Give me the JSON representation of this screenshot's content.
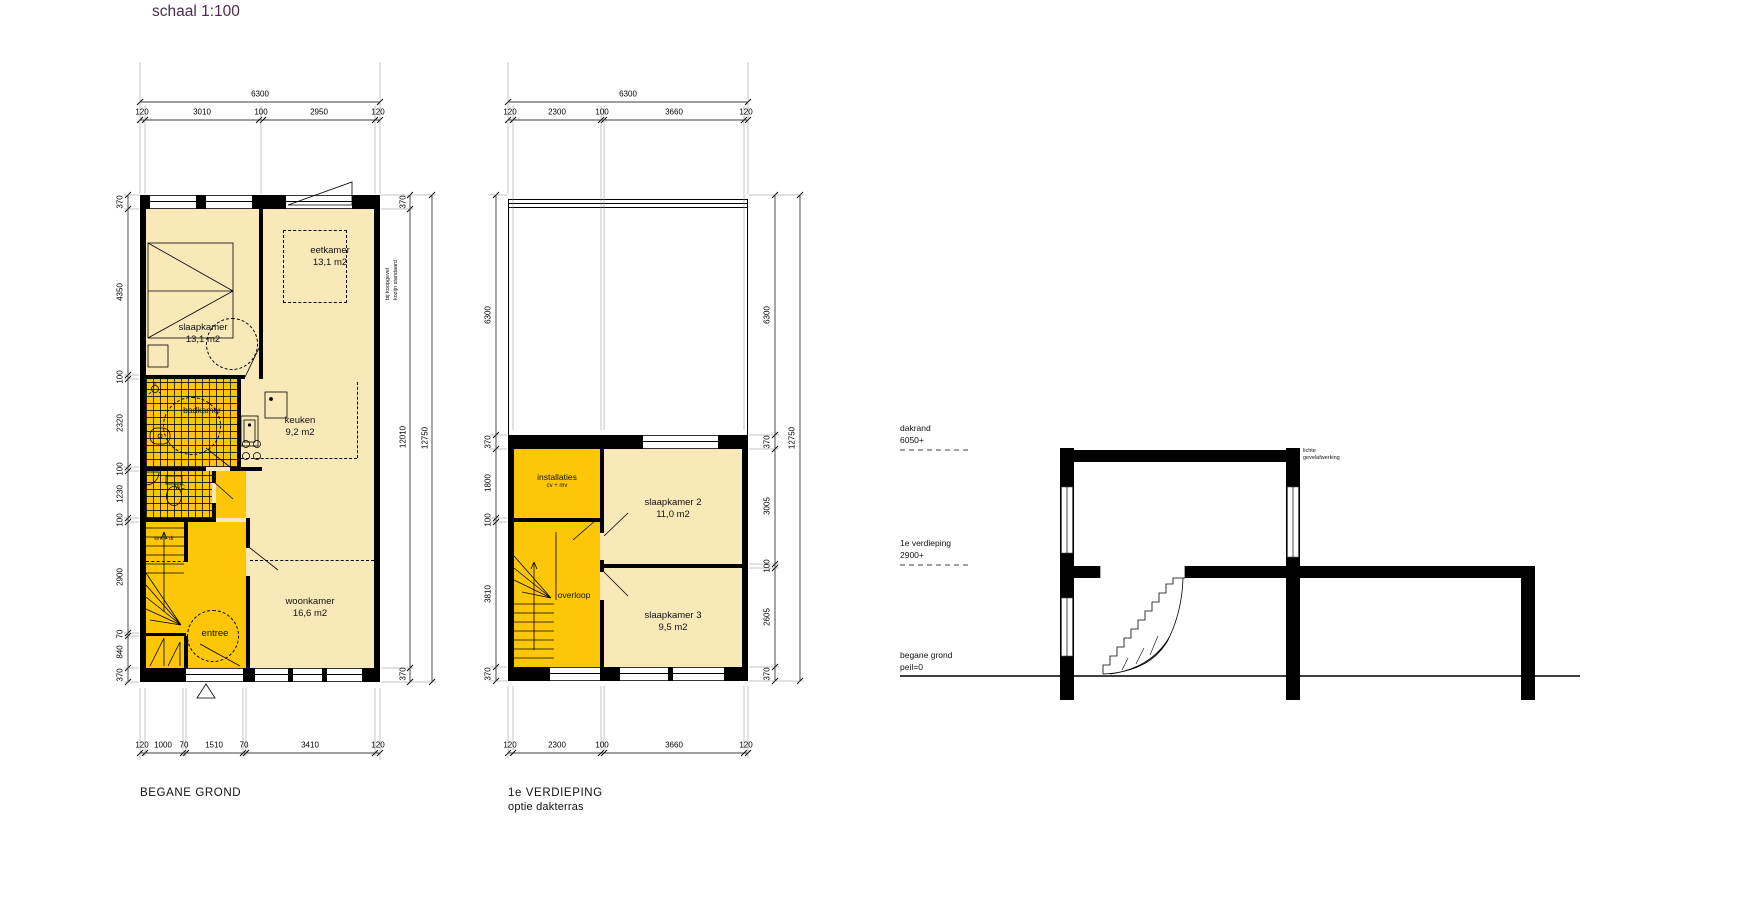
{
  "title": "schaal 1:100",
  "colors": {
    "cream": "#f9e8b8",
    "orange": "#fdc708",
    "wall": "#000000",
    "title": "#4c2b4d"
  },
  "plan1": {
    "name": "BEGANE GROND",
    "rooms": {
      "slaapkamer": {
        "label": "slaapkamer",
        "area": "13,1 m2"
      },
      "eetkamer": {
        "label": "eetkamer",
        "area": "13,1 m2"
      },
      "badkamer": {
        "label": "badkamer"
      },
      "keuken": {
        "label": "keuken",
        "area": "9,2 m2"
      },
      "wc": {
        "label": "WC"
      },
      "wasruimte": {
        "label": "wm + dr"
      },
      "woonkamer": {
        "label": "woonkamer",
        "area": "16,6 m2"
      },
      "entree": {
        "label": "entree"
      }
    },
    "note": {
      "line1": "bij koopgevel",
      "line2": "kozijn standaard"
    },
    "dims": {
      "top_total": "6300",
      "top": [
        "120",
        "3010",
        "100",
        "2950",
        "120"
      ],
      "bottom": [
        "120",
        "1000",
        "70",
        "1510",
        "70",
        "3410",
        "120"
      ],
      "left": [
        "370",
        "4350",
        "100",
        "2320",
        "100",
        "1230",
        "100",
        "2900",
        "70",
        "840",
        "370"
      ],
      "right": [
        "370",
        "12010",
        "370"
      ],
      "right_outer": "12750"
    }
  },
  "plan2": {
    "name": "1e VERDIEPING",
    "subtitle": "optie dakterras",
    "rooms": {
      "installaties": {
        "label": "installaties",
        "sub": "cv + mv"
      },
      "slaapkamer2": {
        "label": "slaapkamer 2",
        "area": "11,0 m2"
      },
      "overloop": {
        "label": "overloop"
      },
      "slaapkamer3": {
        "label": "slaapkamer 3",
        "area": "9,5 m2"
      }
    },
    "dims": {
      "top_total": "6300",
      "top": [
        "120",
        "2300",
        "100",
        "3660",
        "120"
      ],
      "bottom": [
        "120",
        "2300",
        "100",
        "3660",
        "120"
      ],
      "left": [
        "6300",
        "370",
        "1800",
        "100",
        "3810",
        "370"
      ],
      "right": [
        "6300",
        "370",
        "3005",
        "100",
        "2605",
        "370"
      ],
      "right_outer": "12750"
    }
  },
  "section": {
    "levels": [
      {
        "name": "dakrand",
        "value": "6050+"
      },
      {
        "name": "1e verdieping",
        "value": "2900+"
      },
      {
        "name": "begane grond",
        "value": "peil=0"
      }
    ],
    "note": {
      "line1": "lichte",
      "line2": "gevelafwerking"
    }
  }
}
